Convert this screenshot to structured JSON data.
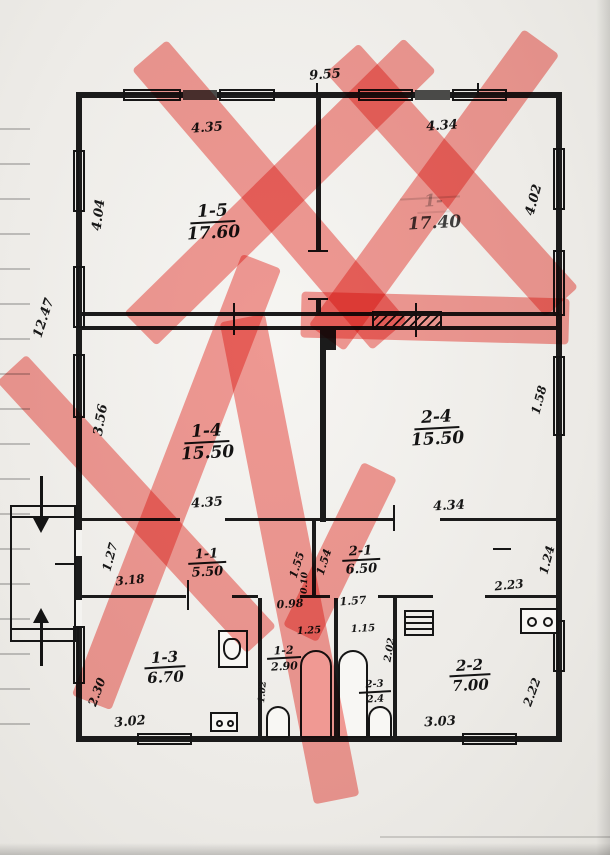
{
  "plan": {
    "title": "apartment floor plan (scanned, hand-drawn, sections crossed out in red)",
    "overall": {
      "top_width": "9.55",
      "left_height": "12.47"
    },
    "rooms": [
      {
        "number": "1-5",
        "area": "17.60"
      },
      {
        "number": "1-",
        "area": "17.40"
      },
      {
        "number": "1-4",
        "area": "15.50"
      },
      {
        "number": "2-4",
        "area": "15.50"
      },
      {
        "number": "1-1",
        "area": "5.50"
      },
      {
        "number": "2-1",
        "area": "6.50"
      },
      {
        "number": "1-3",
        "area": "6.70"
      },
      {
        "number": "1-2",
        "area": "2.90"
      },
      {
        "number": "2-3",
        "area": "2.4"
      },
      {
        "number": "2-2",
        "area": "7.00"
      }
    ],
    "dims": {
      "r15_top": "4.35",
      "r1x_top": "4.34",
      "r15_left": "4.04",
      "r1x_right": "4.02",
      "r14_left": "3.56",
      "r24_right": "1.58",
      "r14_bottom": "4.35",
      "r24_bottom": "4.34",
      "r11_left": "1.27",
      "r21_right": "1.24",
      "r11_width": "3.18",
      "r21_width": "2.23",
      "hall_left": "1.55",
      "hall_right": "1.54",
      "wall_thk": "0.10",
      "door_left": "0.98",
      "door_right": "1.57",
      "r12_top": "1.25",
      "r23_top": "1.15",
      "r23_right": "2.02",
      "r12_left": "1.02",
      "r13_left": "2.30",
      "r13_bottom": "3.02",
      "r22_right": "2.22",
      "r22_bottom": "3.03"
    }
  }
}
